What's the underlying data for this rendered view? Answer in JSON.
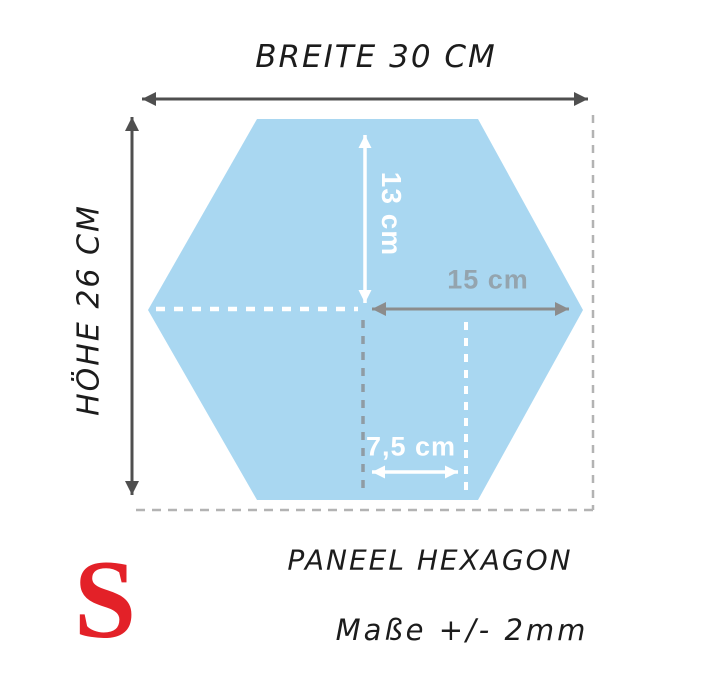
{
  "diagram": {
    "product_title": "PANEEL HEXAGON",
    "tolerance_note": "Maße +/- 2mm",
    "watermark_letter": "S",
    "dimensions": {
      "overall_width_label": "BREITE 30 CM",
      "overall_height_label": "HÖHE 26 CM",
      "center_to_top": "13 cm",
      "center_to_right_vertex": "15 cm",
      "half_edge": "7,5 cm"
    },
    "colors": {
      "hexagon_fill": "#a9d7f1",
      "dim_arrow_dark": "#4f4f4f",
      "dim_arrow_gray": "#8c8c8c",
      "dim_text_gray": "#94a4ae",
      "guide_dash_gray": "#8f9ca4",
      "boundary_dash_gray": "#b3b3b3",
      "guide_dash_white": "#ffffff",
      "watermark_red": "#e32128",
      "text_dark": "#1c1c1c"
    }
  }
}
